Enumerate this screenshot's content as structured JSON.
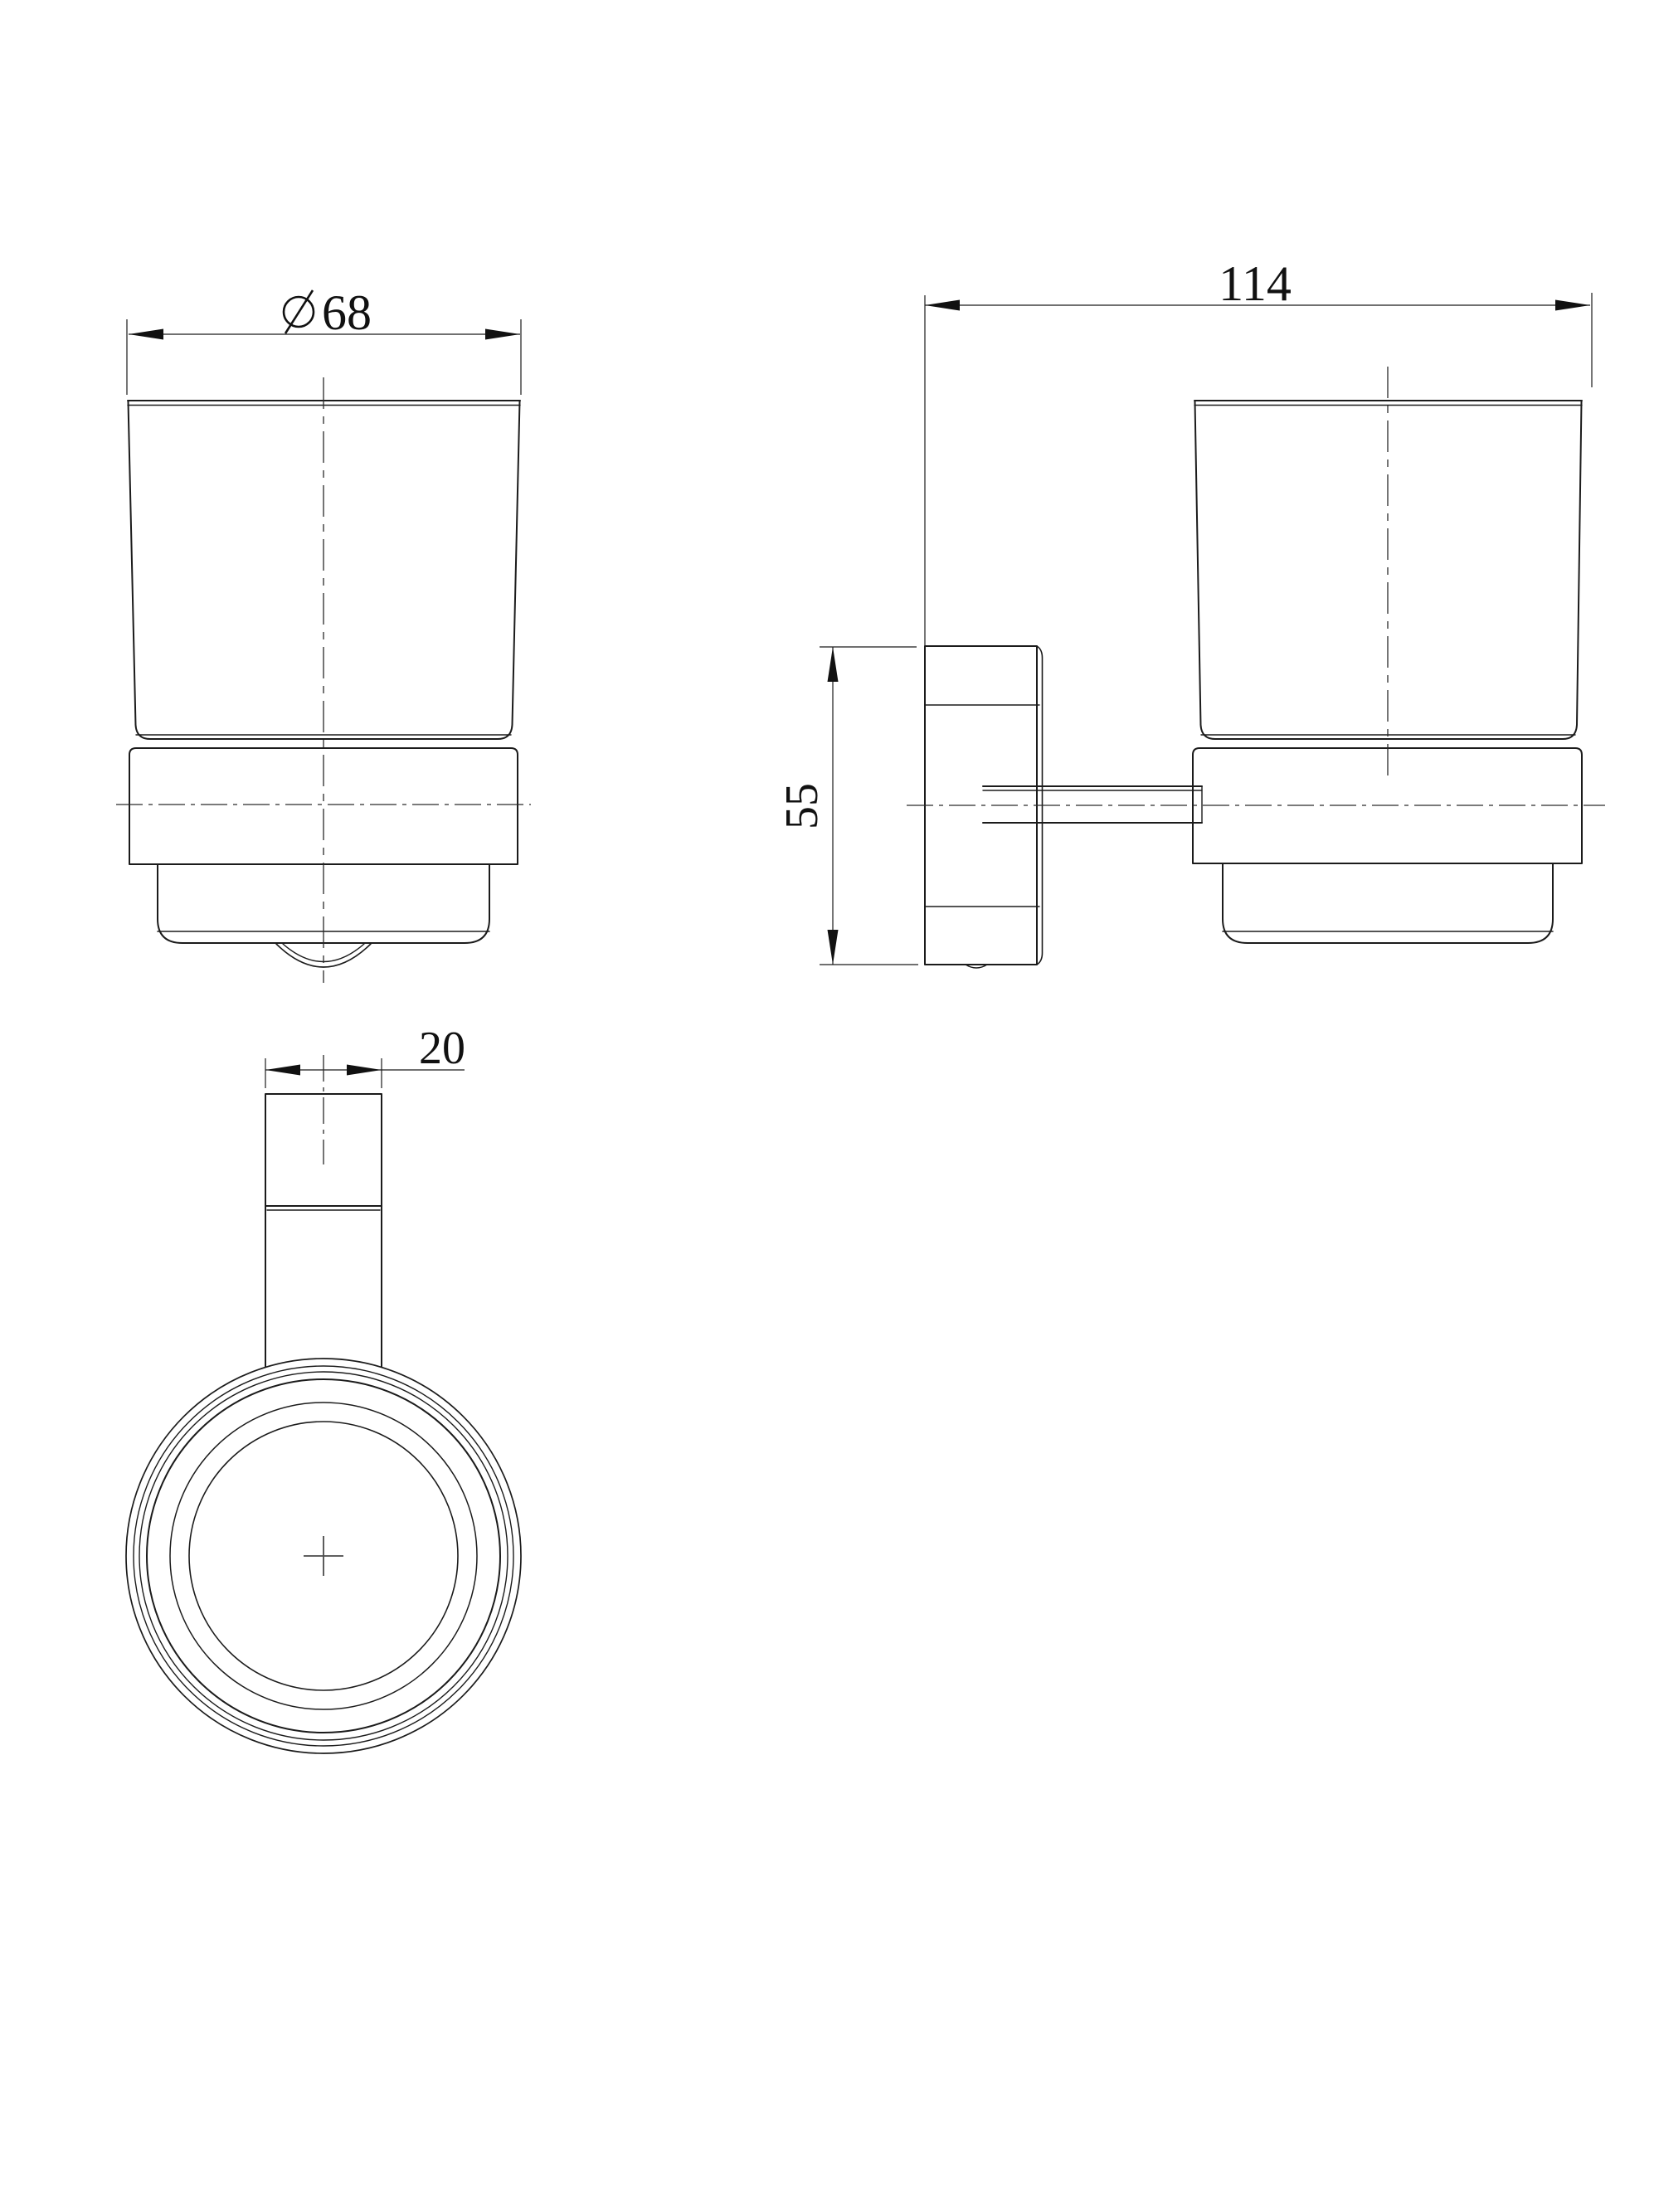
{
  "canvas": {
    "background": "#ffffff",
    "line_color": "#1b1b1b"
  },
  "drawing": {
    "type": "technical-orthographic-drawing",
    "subject": "wall-mounted glass tumbler holder",
    "views": {
      "front": {
        "title": "front view",
        "dimensions": {
          "diameter": {
            "symbol": "∅",
            "value": "68"
          }
        }
      },
      "side": {
        "title": "side view",
        "dimensions": {
          "depth": {
            "value": "114"
          },
          "height": {
            "value": "55"
          }
        }
      },
      "plan": {
        "title": "top view",
        "dimensions": {
          "post_width": {
            "value": "20"
          }
        }
      }
    }
  }
}
